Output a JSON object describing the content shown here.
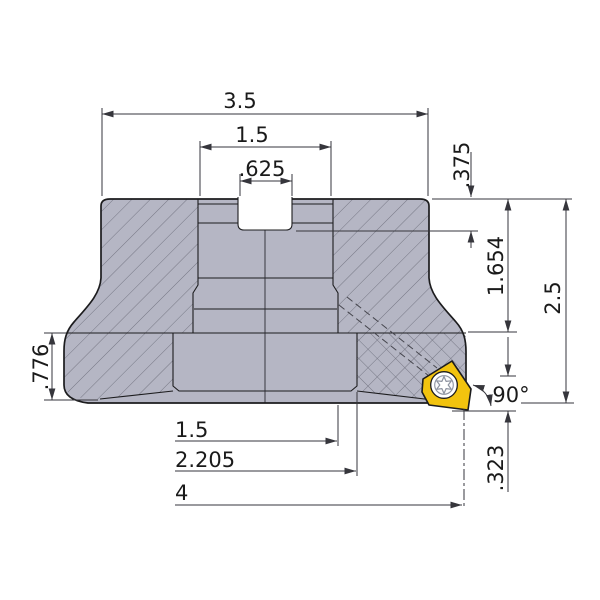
{
  "figure": {
    "subject": "face-mill-cross-section-drawing",
    "parts": {
      "body": "cutter-body-section",
      "insert": "carbide-insert",
      "screw": "torx-screw-icon"
    }
  },
  "dims": {
    "top_width": "3.5",
    "hub_width": "1.5",
    "keyslot_width": ".625",
    "recess_depth": ".375",
    "neck_height": "1.654",
    "overall_height": "2.5",
    "flange_height": ".776",
    "bore_diameter": "1.5",
    "hub_diameter": "2.205",
    "cutting_diameter": "4",
    "tip_offset": ".323",
    "lead_angle": "90°"
  },
  "colors": {
    "body_fill": "#b5b6c4",
    "hatch_line": "#6e6f7d",
    "insert_fill": "#f2c30e",
    "outline": "#1c1c1e",
    "dimension_line": "#36363c",
    "screw_detail": "#8d93a0",
    "background": "#ffffff"
  }
}
